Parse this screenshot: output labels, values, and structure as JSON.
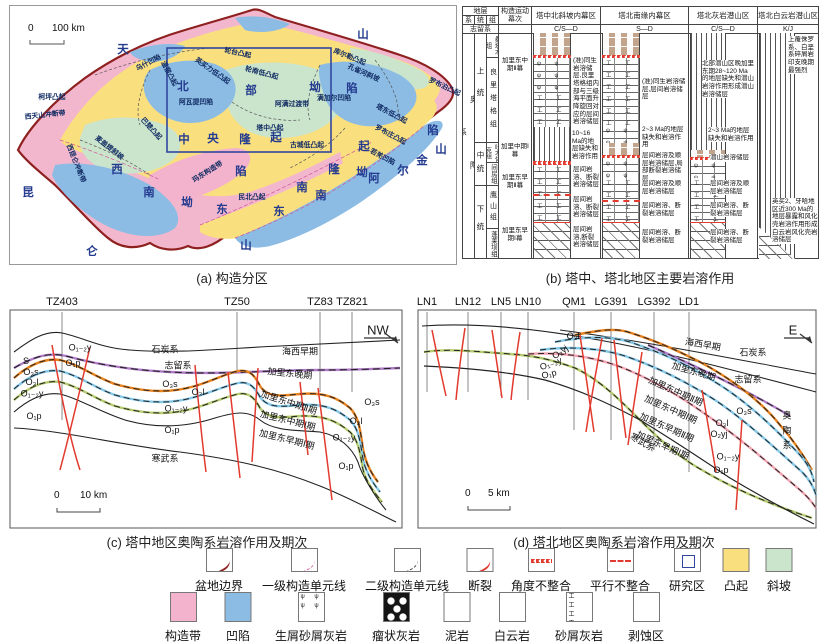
{
  "colors": {
    "uplift_yellow": "#FADF7F",
    "sag_blue": "#8CBCE4",
    "slope_green": "#CBE5CC",
    "belt_pink": "#F3B3CC",
    "basin_boundary_red": "#8E2020",
    "fault_red": "#E23A2E",
    "study_rect_blue": "#31479E",
    "horizon_orange": "#E8821E",
    "horizon_blue": "#85C8E8",
    "horizon_green": "#B5CC70",
    "horizon_purple": "#B07CC8",
    "horizon_pink": "#F2A6B4",
    "mudstone_brown": "#C2A48D"
  },
  "captions": {
    "a": "(a) 构造分区",
    "b": "(b) 塔中、塔北地区主要岩溶作用",
    "c": "(c) 塔中地区奥陶系岩溶作用及期次",
    "d": "(d) 塔北地区奥陶系岩溶作用及期次"
  },
  "map": {
    "scale_zero": "0",
    "scale_label": "100 km",
    "big_chars": [
      {
        "t": "天",
        "x": 123,
        "y": 49
      },
      {
        "t": "山",
        "x": 363,
        "y": 34
      },
      {
        "t": "昆",
        "x": 28,
        "y": 192
      },
      {
        "t": "仑",
        "x": 92,
        "y": 251
      },
      {
        "t": "山",
        "x": 246,
        "y": 245
      },
      {
        "t": "阿",
        "x": 374,
        "y": 178
      },
      {
        "t": "尔",
        "x": 403,
        "y": 170
      },
      {
        "t": "金",
        "x": 422,
        "y": 160
      },
      {
        "t": "山",
        "x": 441,
        "y": 149
      },
      {
        "t": "北",
        "x": 183,
        "y": 86
      },
      {
        "t": "部",
        "x": 251,
        "y": 90
      },
      {
        "t": "坳",
        "x": 315,
        "y": 87
      },
      {
        "t": "陷",
        "x": 352,
        "y": 88
      },
      {
        "t": "中",
        "x": 184,
        "y": 139
      },
      {
        "t": "央",
        "x": 213,
        "y": 138
      },
      {
        "t": "隆",
        "x": 245,
        "y": 139
      },
      {
        "t": "起",
        "x": 276,
        "y": 137
      },
      {
        "t": "西",
        "x": 117,
        "y": 169
      },
      {
        "t": "南",
        "x": 149,
        "y": 192
      },
      {
        "t": "坳",
        "x": 187,
        "y": 202
      },
      {
        "t": "陷",
        "x": 241,
        "y": 171
      },
      {
        "t": "东",
        "x": 222,
        "y": 209
      },
      {
        "t": "南",
        "x": 302,
        "y": 187
      },
      {
        "t": "隆",
        "x": 334,
        "y": 169
      },
      {
        "t": "起",
        "x": 364,
        "y": 146
      },
      {
        "t": "东",
        "x": 279,
        "y": 211
      },
      {
        "t": "南",
        "x": 321,
        "y": 195
      },
      {
        "t": "坳",
        "x": 362,
        "y": 172
      },
      {
        "t": "陷",
        "x": 433,
        "y": 130
      }
    ],
    "units": [
      {
        "t": "乌什凹陷",
        "x": 148,
        "y": 62,
        "r": -28
      },
      {
        "t": "温宿凸起",
        "x": 170,
        "y": 73,
        "r": 62
      },
      {
        "t": "英买力低凸起",
        "x": 213,
        "y": 70,
        "r": 35
      },
      {
        "t": "轮台凸起",
        "x": 238,
        "y": 52,
        "r": 12
      },
      {
        "t": "轮南低凸起",
        "x": 262,
        "y": 72,
        "r": 15
      },
      {
        "t": "库尔勒凸起",
        "x": 350,
        "y": 56,
        "r": 22
      },
      {
        "t": "孔雀河斜坡",
        "x": 364,
        "y": 72,
        "r": 24
      },
      {
        "t": "罗布泊凸起",
        "x": 445,
        "y": 86,
        "r": 25
      },
      {
        "t": "柯坪凸起",
        "x": 52,
        "y": 96,
        "r": 0
      },
      {
        "t": "阿瓦提凹陷",
        "x": 196,
        "y": 101,
        "r": 0
      },
      {
        "t": "阿满过渡带",
        "x": 292,
        "y": 103,
        "r": 0
      },
      {
        "t": "满加尔凹陷",
        "x": 334,
        "y": 97,
        "r": 0
      },
      {
        "t": "巴楚凸起",
        "x": 152,
        "y": 128,
        "r": 48
      },
      {
        "t": "塔中凸起",
        "x": 270,
        "y": 127,
        "r": 0
      },
      {
        "t": "古城低凸起",
        "x": 307,
        "y": 144,
        "r": 0
      },
      {
        "t": "塔东低凸起",
        "x": 392,
        "y": 113,
        "r": 28
      },
      {
        "t": "罗布庄凸起",
        "x": 391,
        "y": 134,
        "r": 28
      },
      {
        "t": "若羌凹陷",
        "x": 383,
        "y": 156,
        "r": 28
      },
      {
        "t": "西天山冲断带",
        "x": 45,
        "y": 114,
        "r": -6
      },
      {
        "t": "西昆仑冲断带",
        "x": 77,
        "y": 163,
        "r": 68
      },
      {
        "t": "麦盖提斜坡",
        "x": 110,
        "y": 147,
        "r": 38
      },
      {
        "t": "玛东构造带",
        "x": 207,
        "y": 171,
        "r": -32
      },
      {
        "t": "民北凸起",
        "x": 252,
        "y": 196,
        "r": 0
      }
    ]
  },
  "karst": {
    "header": {
      "strata": "地层",
      "xi": "系",
      "tong": "统",
      "zu": "组",
      "episode_col": "构造运动幕次",
      "regions": [
        "塔中北斜坡内幕区",
        "塔北南缘内幕区",
        "塔北灰岩潜山区",
        "塔北白云岩潜山区"
      ],
      "silurian": "志留系",
      "ages": [
        "C/S—D",
        "S—D",
        "C/S—D",
        "K/J"
      ]
    },
    "system": "奥陶系",
    "series": [
      "上统",
      "中统",
      "下统"
    ],
    "formations": [
      "桑塔木组",
      "良里塔格组",
      "吐木休克组",
      "间房组",
      "鹰山组",
      "蓬莱坝组"
    ],
    "episodes": [
      "加里东中期Ⅱ幕",
      "加里中期Ⅰ幕",
      "加里东早期Ⅱ幕",
      "加里东早期Ⅰ幕"
    ],
    "c1": {
      "t1": "(准)同生岩溶储层,良里塔格组内部与三级海平面升降旋回对应的层间岩溶储层",
      "t2": "10~16 Ma的地层缺失和岩溶作用",
      "t3": "层间岩溶、断裂岩溶储层",
      "t4": "层间岩溶、断裂岩溶储层",
      "t5": "层间岩溶,断裂岩溶储层"
    },
    "c2": {
      "t1": "(准)同生岩溶储层,层间岩溶储层",
      "t2": "2~3 Ma的地层缺失和岩溶作用",
      "t3": "层间岩溶及顺层岩溶储层,局部断裂岩溶储层",
      "t4": "层间岩溶及顺层岩溶储层",
      "t5": "层间岩溶、断裂岩溶储层",
      "t6": "层间岩溶、断裂岩溶储层"
    },
    "c3": {
      "t1": "北部潜山区晚加里东期28~120 Ma的地层缺失和潜山岩溶作用形成潜山岩溶储层",
      "t2": "2~3 Ma的地层缺失和岩溶作用",
      "t3": "潜山岩溶储层",
      "t4": "层间岩溶及顺层岩溶储层",
      "t5": "层间岩溶、断裂岩溶储层",
      "t6": "层间岩溶、断裂岩溶储层"
    },
    "c4": {
      "t1": "上覆侏罗系、白垩系碎屑岩印支晚期最强烈",
      "t2": "英买2、牙哈地区近300 Ma的地层暴露和风化壳岩溶作用形成白云岩风化壳岩溶储层"
    }
  },
  "section_c": {
    "direction": "NW",
    "scale_zero": "0",
    "scale_label": "10 km",
    "wells": [
      {
        "n": "TZ403",
        "x": 62
      },
      {
        "n": "TZ50",
        "x": 237
      },
      {
        "n": "TZ83",
        "x": 320
      },
      {
        "n": "TZ821",
        "x": 352
      }
    ],
    "labels": [
      {
        "t": "石炭系",
        "x": 165,
        "y": 349
      },
      {
        "t": "海西早期",
        "x": 300,
        "y": 351
      },
      {
        "t": "志留系",
        "x": 178,
        "y": 365
      },
      {
        "t": "加里东晚期",
        "x": 290,
        "y": 373,
        "r": 6
      },
      {
        "t": "S",
        "x": 26,
        "y": 361
      },
      {
        "t": "O₃s",
        "x": 31,
        "y": 372
      },
      {
        "t": "O₃l",
        "x": 32,
        "y": 382
      },
      {
        "t": "O₁₋₂y",
        "x": 32,
        "y": 394
      },
      {
        "t": "O₁p",
        "x": 34,
        "y": 416
      },
      {
        "t": "O₁₋₂y",
        "x": 80,
        "y": 348
      },
      {
        "t": "O₁p",
        "x": 73,
        "y": 363
      },
      {
        "t": "O₃s",
        "x": 170,
        "y": 384
      },
      {
        "t": "O₃l",
        "x": 198,
        "y": 392
      },
      {
        "t": "O₁₋₂y",
        "x": 176,
        "y": 409
      },
      {
        "t": "O₁p",
        "x": 172,
        "y": 430
      },
      {
        "t": "寒武系",
        "x": 165,
        "y": 458
      },
      {
        "t": "加里东中期Ⅱ期",
        "x": 289,
        "y": 402,
        "r": 18
      },
      {
        "t": "加里东中期Ⅰ期",
        "x": 288,
        "y": 420,
        "r": 14
      },
      {
        "t": "加里东早期Ⅰ期",
        "x": 287,
        "y": 439,
        "r": 14
      },
      {
        "t": "O₃s",
        "x": 372,
        "y": 402
      },
      {
        "t": "O₃l",
        "x": 356,
        "y": 421
      },
      {
        "t": "O₁₋₂y",
        "x": 344,
        "y": 438
      },
      {
        "t": "O₁p",
        "x": 346,
        "y": 466
      }
    ]
  },
  "section_d": {
    "direction": "E",
    "scale_zero": "0",
    "scale_label": "5 km",
    "wells": [
      {
        "n": "LN1",
        "x": 427
      },
      {
        "n": "LN12",
        "x": 468
      },
      {
        "n": "LN5",
        "x": 501
      },
      {
        "n": "LN10",
        "x": 528
      },
      {
        "n": "QM1",
        "x": 574
      },
      {
        "n": "LG391",
        "x": 611
      },
      {
        "n": "LG392",
        "x": 654
      },
      {
        "n": "LD1",
        "x": 689
      }
    ],
    "labels": [
      {
        "t": "海西早期",
        "x": 703,
        "y": 344,
        "r": 10
      },
      {
        "t": "石炭系",
        "x": 753,
        "y": 352
      },
      {
        "t": "加里东晚期",
        "x": 694,
        "y": 371,
        "r": 16
      },
      {
        "t": "志留系",
        "x": 748,
        "y": 379
      },
      {
        "t": "O₃s",
        "x": 744,
        "y": 411
      },
      {
        "t": "O₃l",
        "x": 722,
        "y": 423
      },
      {
        "t": "O₂yj",
        "x": 719,
        "y": 434
      },
      {
        "t": "O₁₋₂y",
        "x": 728,
        "y": 457
      },
      {
        "t": "O₁p",
        "x": 721,
        "y": 470
      },
      {
        "t": "O₃l",
        "x": 573,
        "y": 336
      },
      {
        "t": "O₂yj",
        "x": 560,
        "y": 352,
        "r": -35
      },
      {
        "t": "O₁₋₂y",
        "x": 551,
        "y": 364,
        "r": -20
      },
      {
        "t": "O₁p",
        "x": 549,
        "y": 374,
        "r": -15
      },
      {
        "t": "加里东中期Ⅱ期",
        "x": 676,
        "y": 391,
        "r": 24
      },
      {
        "t": "加里东中期Ⅰ期",
        "x": 671,
        "y": 409,
        "r": 24
      },
      {
        "t": "加里东早期Ⅱ期",
        "x": 667,
        "y": 427,
        "r": 24
      },
      {
        "t": "加里东早期Ⅰ期",
        "x": 663,
        "y": 445,
        "r": 24
      },
      {
        "t": "寒武系",
        "x": 643,
        "y": 442,
        "r": 30
      },
      {
        "t": "奥",
        "x": 787,
        "y": 415
      },
      {
        "t": "陶",
        "x": 787,
        "y": 430
      },
      {
        "t": "系",
        "x": 787,
        "y": 445
      }
    ]
  },
  "legend": {
    "row1": [
      {
        "label": "盆地边界",
        "type": "basin",
        "x": 219
      },
      {
        "label": "一级构造单元线",
        "type": "first",
        "x": 304
      },
      {
        "label": "二级构造单元线",
        "type": "second",
        "x": 407
      },
      {
        "label": "断裂",
        "type": "fault",
        "x": 480
      },
      {
        "label": "角度不整合",
        "type": "angular",
        "x": 541
      },
      {
        "label": "平行不整合",
        "type": "parallel",
        "x": 620
      },
      {
        "label": "研究区",
        "type": "study",
        "x": 687
      },
      {
        "label": "凸起",
        "type": "uplift",
        "x": 736
      },
      {
        "label": "斜坡",
        "type": "slope",
        "x": 779
      }
    ],
    "row2": [
      {
        "label": "构造带",
        "type": "belt",
        "x": 183
      },
      {
        "label": "凹陷",
        "type": "sag",
        "x": 238
      },
      {
        "label": "生屑砂屑灰岩",
        "type": "psi",
        "x": 311
      },
      {
        "label": "瘤状灰岩",
        "type": "nodular",
        "x": 396
      },
      {
        "label": "泥岩",
        "type": "mud",
        "x": 457
      },
      {
        "label": "白云岩",
        "type": "dolo",
        "x": 512
      },
      {
        "label": "砂屑灰岩",
        "type": "sandy",
        "x": 579
      },
      {
        "label": "剥蚀区",
        "type": "erode",
        "x": 646
      }
    ]
  }
}
